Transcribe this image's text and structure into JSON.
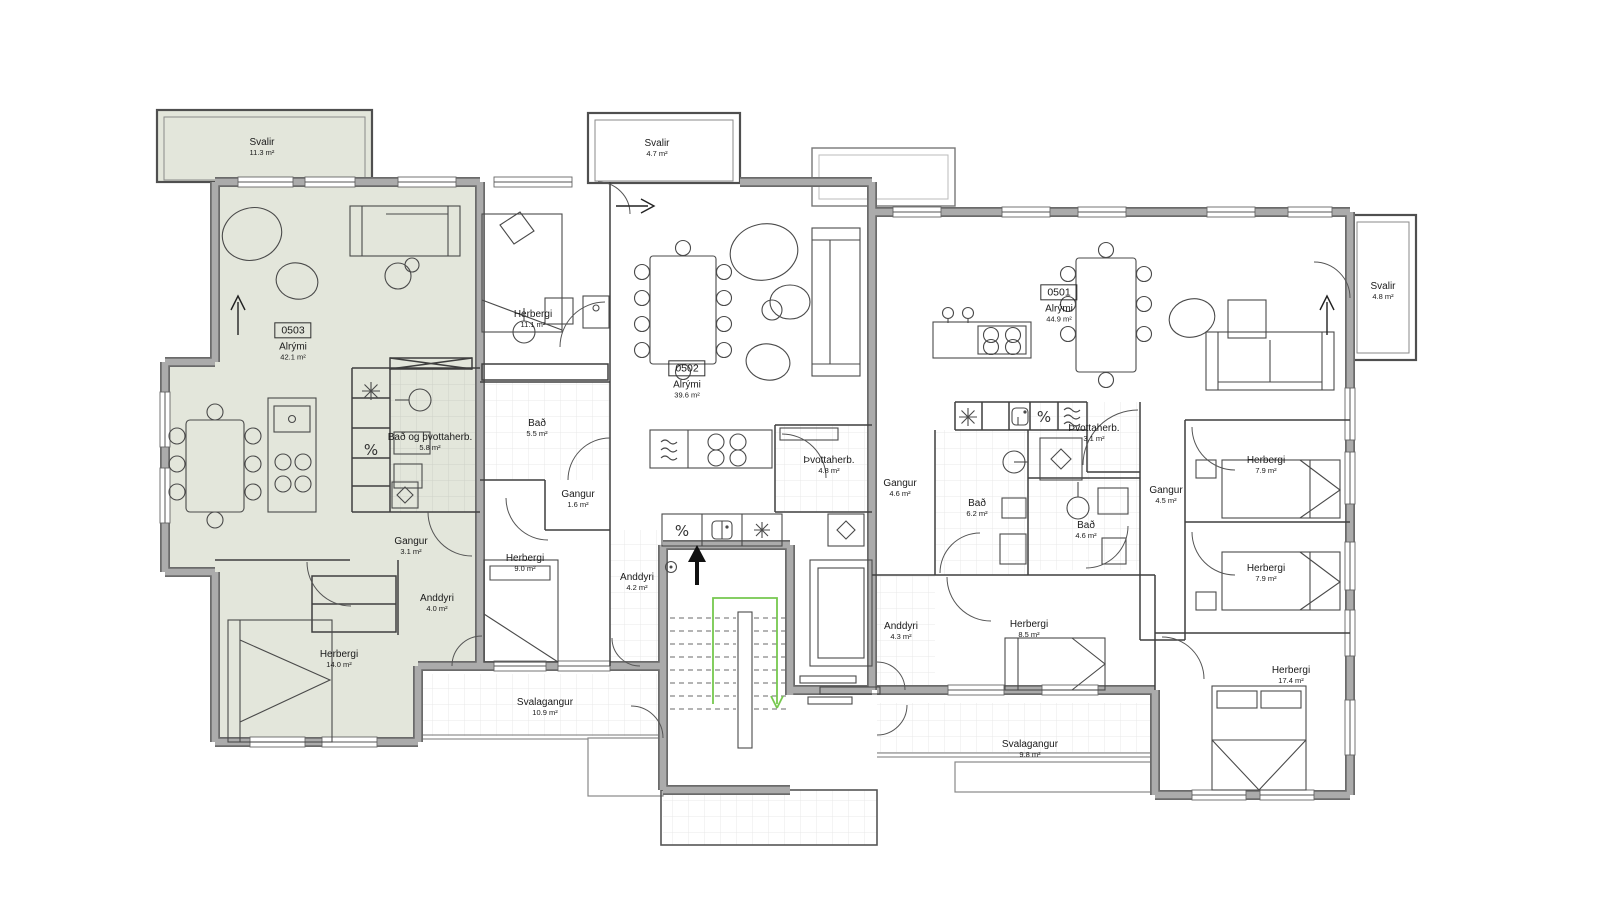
{
  "units": [
    {
      "number": "0503",
      "room": "Alrými",
      "area": "42.1 m²"
    },
    {
      "number": "0502",
      "room": "Alrými",
      "area": "39.6 m²"
    },
    {
      "number": "0501",
      "room": "Alrými",
      "area": "44.9 m²"
    }
  ],
  "labels": [
    {
      "name": "Svalir",
      "area": "11.3 m²"
    },
    {
      "name": "Bað og þvottaherb.",
      "area": "5.8 m²"
    },
    {
      "name": "Gangur",
      "area": "3.1 m²"
    },
    {
      "name": "Anddyri",
      "area": "4.0 m²"
    },
    {
      "name": "Herbergi",
      "area": "14.0 m²"
    },
    {
      "name": "Herbergi",
      "area": "11.1 m²"
    },
    {
      "name": "Bað",
      "area": "5.5 m²"
    },
    {
      "name": "Gangur",
      "area": "1.6 m²"
    },
    {
      "name": "Herbergi",
      "area": "9.0 m²"
    },
    {
      "name": "Anddyri",
      "area": "4.2 m²"
    },
    {
      "name": "Svalir",
      "area": "4.7 m²"
    },
    {
      "name": "Þvottaherb.",
      "area": "4.8 m²"
    },
    {
      "name": "Þvottaherb.",
      "area": "3.1 m²"
    },
    {
      "name": "Gangur",
      "area": "4.6 m²"
    },
    {
      "name": "Bað",
      "area": "6.2 m²"
    },
    {
      "name": "Bað",
      "area": "4.6 m²"
    },
    {
      "name": "Gangur",
      "area": "4.5 m²"
    },
    {
      "name": "Herbergi",
      "area": "7.9 m²"
    },
    {
      "name": "Herbergi",
      "area": "7.9 m²"
    },
    {
      "name": "Anddyri",
      "area": "4.3 m²"
    },
    {
      "name": "Herbergi",
      "area": "8.5 m²"
    },
    {
      "name": "Herbergi",
      "area": "17.4 m²"
    },
    {
      "name": "Svalir",
      "area": "4.8 m²"
    },
    {
      "name": "Svalagangur",
      "area": "10.9 m²"
    },
    {
      "name": "Svalagangur",
      "area": "9.8 m²"
    }
  ],
  "icons": {
    "washer": "%",
    "fridge": "asterisk-shape",
    "dishwasher": "waves-shape",
    "dryer": "drum-shape",
    "vent": "diamond-shape",
    "sink": "basin-shape"
  },
  "colors": {
    "highlight_fill": "#e3e6db",
    "wall_gray": "#ababab",
    "wall_dark": "#6b6b6b",
    "stair_route_green": "#76c84e"
  }
}
